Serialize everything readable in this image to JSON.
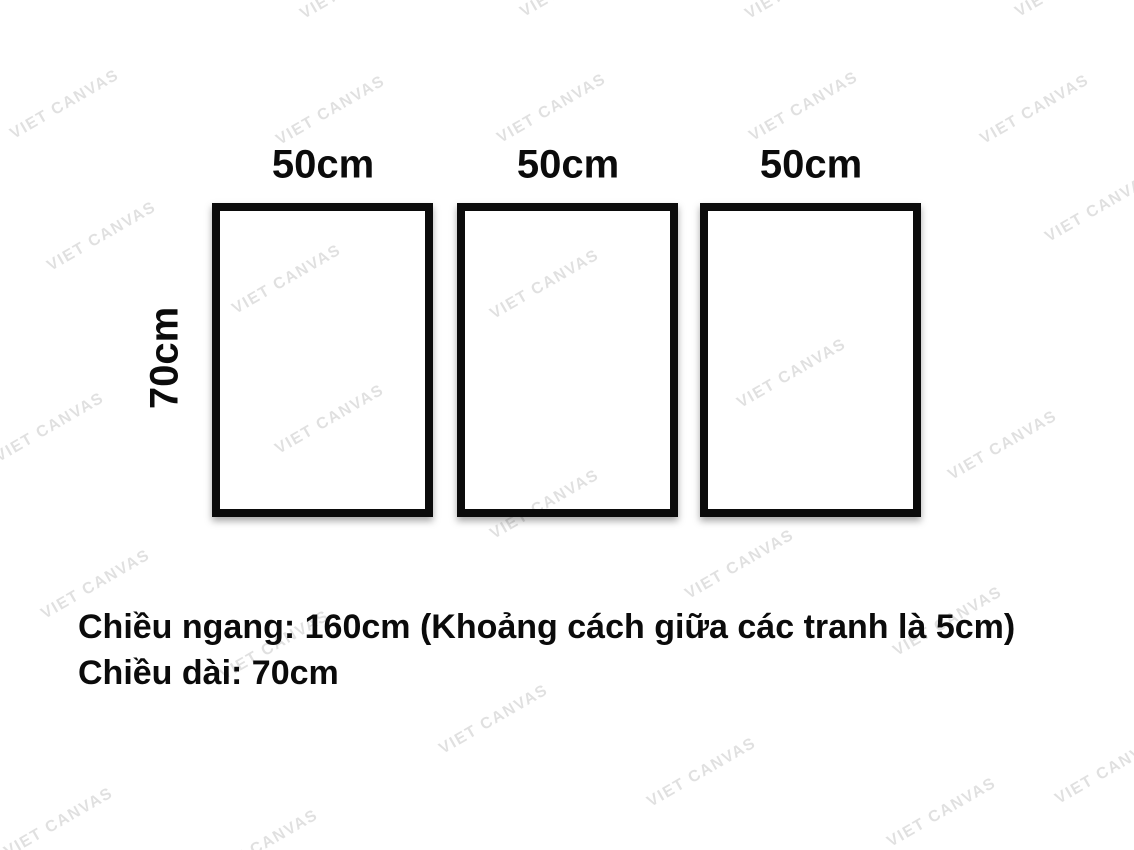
{
  "watermark": {
    "text": "VIET CANVAS"
  },
  "frames": [
    {
      "width_label": "50cm"
    },
    {
      "width_label": "50cm"
    },
    {
      "width_label": "50cm"
    }
  ],
  "height_label": "70cm",
  "notes": {
    "line1": "Chiều ngang: 160cm (Khoảng cách giữa các tranh là 5cm)",
    "line2": "Chiều dài: 70cm"
  },
  "colors": {
    "background": "#ffffff",
    "frame_border": "#0b0b0b",
    "text": "#0b0b0b",
    "watermark": "rgba(0,0,0,0.12)"
  }
}
